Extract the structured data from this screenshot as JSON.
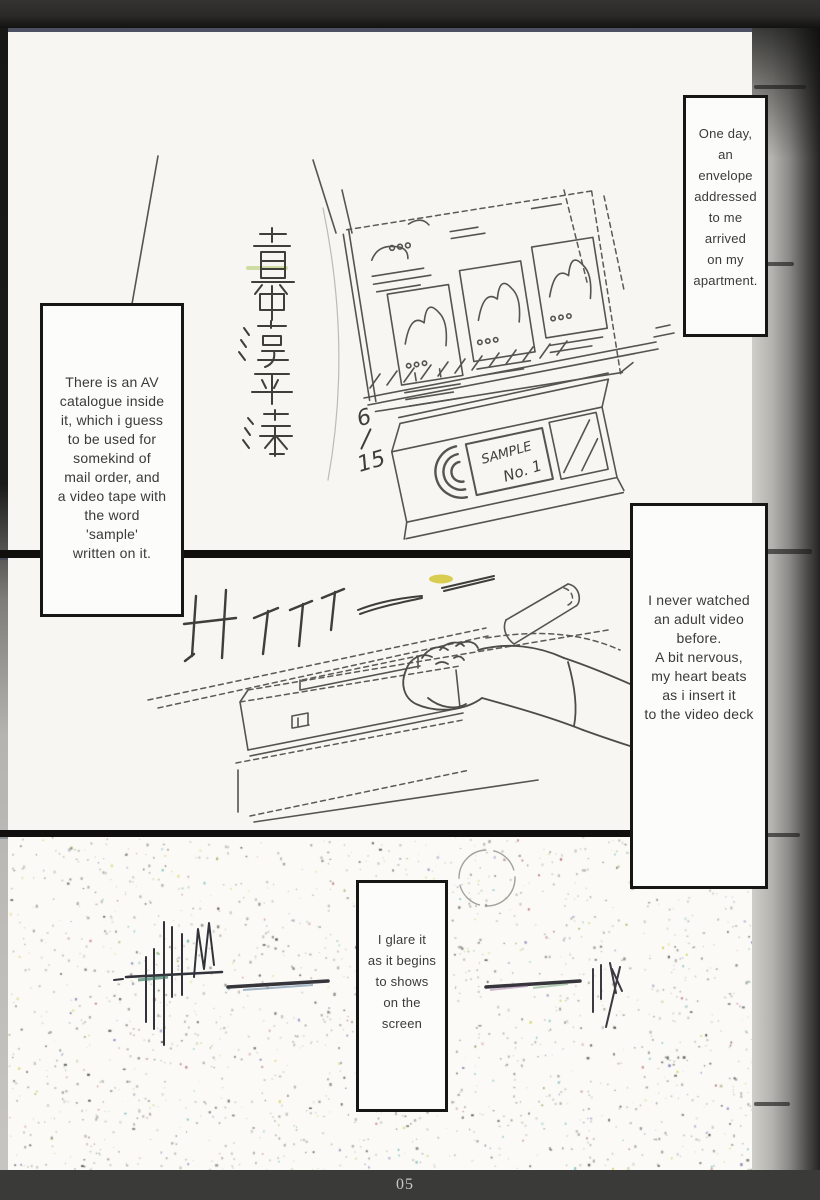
{
  "page": {
    "number": "05"
  },
  "captions": {
    "box1": "One day,\nan\nenvelope\naddressed\nto me\narrived\non my\napartment.",
    "box2": "There is an AV\ncatalogue inside\nit, which i guess\nto be used for\nsomekind of\nmail order, and\na video tape with\nthe word\n'sample'\nwritten on it.",
    "box3": "I never watched\nan adult video\nbefore.\nA bit nervous,\nmy heart beats\nas i insert it\nto the video deck",
    "box4": "I glare it\nas it begins\nto shows\non the\nscreen"
  },
  "artwork": {
    "tape_label_top": "SAMPLE",
    "tape_label_bottom": "No. 1",
    "date_mark_top": "6",
    "date_mark_bottom": "15",
    "address_calligraphy": "真中淳平様",
    "colors": {
      "paper": "#f7f6f2",
      "frame_black": "#161614",
      "highlight_yellow": "#d2c634",
      "highlight_green": "#b9cf7a"
    }
  }
}
